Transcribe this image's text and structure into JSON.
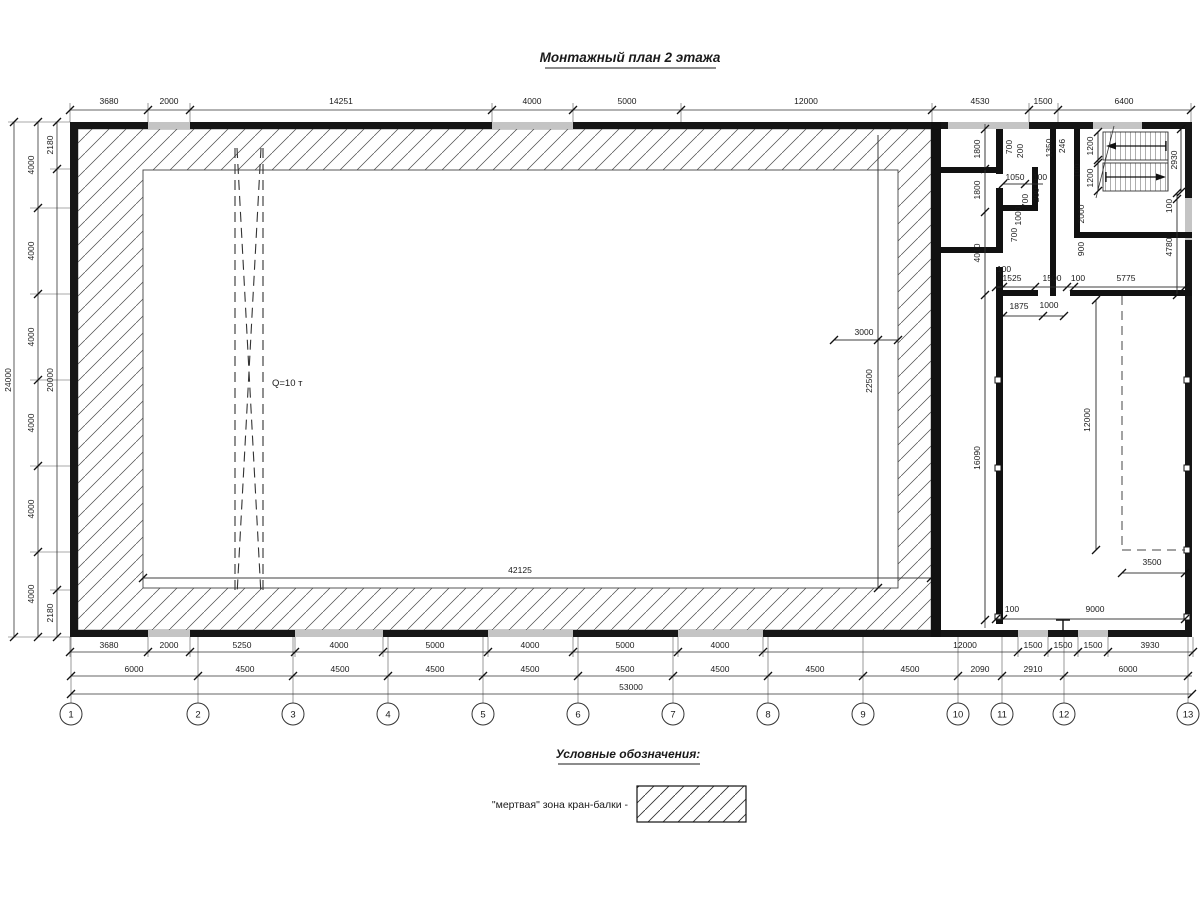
{
  "title": "Монтажный план 2 этажа",
  "legend": {
    "heading": "Условные обозначения:",
    "items": [
      {
        "label": "\"мертвая\" зона кран-балки -",
        "symbol": "hatched-rect"
      }
    ]
  },
  "crane": {
    "capacity_label": "Q=10 т"
  },
  "axis_bubbles": [
    "1",
    "2",
    "3",
    "4",
    "5",
    "6",
    "7",
    "8",
    "9",
    "10",
    "11",
    "12",
    "13"
  ],
  "dimension_labels": [
    {
      "t": "3680",
      "x": 109,
      "y": 104
    },
    {
      "t": "2000",
      "x": 169,
      "y": 104
    },
    {
      "t": "14251",
      "x": 341,
      "y": 104
    },
    {
      "t": "4000",
      "x": 532,
      "y": 104
    },
    {
      "t": "5000",
      "x": 627,
      "y": 104
    },
    {
      "t": "12000",
      "x": 806,
      "y": 104
    },
    {
      "t": "4530",
      "x": 980,
      "y": 104
    },
    {
      "t": "1500",
      "x": 1043,
      "y": 104
    },
    {
      "t": "6400",
      "x": 1124,
      "y": 104
    },
    {
      "t": "3680",
      "x": 109,
      "y": 648
    },
    {
      "t": "2000",
      "x": 169,
      "y": 648
    },
    {
      "t": "5250",
      "x": 242,
      "y": 648
    },
    {
      "t": "4000",
      "x": 339,
      "y": 648
    },
    {
      "t": "5000",
      "x": 435,
      "y": 648
    },
    {
      "t": "4000",
      "x": 530,
      "y": 648
    },
    {
      "t": "5000",
      "x": 625,
      "y": 648
    },
    {
      "t": "4000",
      "x": 720,
      "y": 648
    },
    {
      "t": "12000",
      "x": 965,
      "y": 648
    },
    {
      "t": "1500",
      "x": 1033,
      "y": 648
    },
    {
      "t": "1500",
      "x": 1063,
      "y": 648
    },
    {
      "t": "1500",
      "x": 1093,
      "y": 648
    },
    {
      "t": "3930",
      "x": 1150,
      "y": 648
    },
    {
      "t": "6000",
      "x": 134,
      "y": 672
    },
    {
      "t": "4500",
      "x": 245,
      "y": 672
    },
    {
      "t": "4500",
      "x": 340,
      "y": 672
    },
    {
      "t": "4500",
      "x": 435,
      "y": 672
    },
    {
      "t": "4500",
      "x": 530,
      "y": 672
    },
    {
      "t": "4500",
      "x": 625,
      "y": 672
    },
    {
      "t": "4500",
      "x": 720,
      "y": 672
    },
    {
      "t": "4500",
      "x": 815,
      "y": 672
    },
    {
      "t": "4500",
      "x": 910,
      "y": 672
    },
    {
      "t": "2090",
      "x": 980,
      "y": 672
    },
    {
      "t": "2910",
      "x": 1033,
      "y": 672
    },
    {
      "t": "6000",
      "x": 1128,
      "y": 672
    },
    {
      "t": "53000",
      "x": 631,
      "y": 690
    },
    {
      "t": "4000",
      "x": 34,
      "y": 165,
      "r": 1
    },
    {
      "t": "4000",
      "x": 34,
      "y": 251,
      "r": 1
    },
    {
      "t": "4000",
      "x": 34,
      "y": 337,
      "r": 1
    },
    {
      "t": "4000",
      "x": 34,
      "y": 423,
      "r": 1
    },
    {
      "t": "4000",
      "x": 34,
      "y": 509,
      "r": 1
    },
    {
      "t": "4000",
      "x": 34,
      "y": 594,
      "r": 1
    },
    {
      "t": "24000",
      "x": 11,
      "y": 380,
      "r": 1
    },
    {
      "t": "2180",
      "x": 53,
      "y": 145,
      "r": 1
    },
    {
      "t": "20000",
      "x": 53,
      "y": 380,
      "r": 1
    },
    {
      "t": "2180",
      "x": 53,
      "y": 613,
      "r": 1
    },
    {
      "t": "42125",
      "x": 520,
      "y": 573
    },
    {
      "t": "3000",
      "x": 864,
      "y": 335
    },
    {
      "t": "22500",
      "x": 872,
      "y": 381,
      "r": 1
    },
    {
      "t": "1800",
      "x": 980,
      "y": 149,
      "r": 1
    },
    {
      "t": "1800",
      "x": 980,
      "y": 190,
      "r": 1
    },
    {
      "t": "4010",
      "x": 980,
      "y": 253,
      "r": 1
    },
    {
      "t": "16090",
      "x": 980,
      "y": 458,
      "r": 1
    },
    {
      "t": "700",
      "x": 1012,
      "y": 147,
      "r": 1
    },
    {
      "t": "200",
      "x": 1023,
      "y": 151,
      "r": 1
    },
    {
      "t": "1350",
      "x": 1052,
      "y": 148,
      "r": 1
    },
    {
      "t": "246",
      "x": 1065,
      "y": 146,
      "r": 1
    },
    {
      "t": "1050",
      "x": 1015,
      "y": 180
    },
    {
      "t": "100",
      "x": 1040,
      "y": 180
    },
    {
      "t": "700",
      "x": 1028,
      "y": 201,
      "r": 1
    },
    {
      "t": "200",
      "x": 1039,
      "y": 195,
      "r": 1
    },
    {
      "t": "1000",
      "x": 1021,
      "y": 216,
      "r": 1
    },
    {
      "t": "700",
      "x": 1017,
      "y": 235,
      "r": 1
    },
    {
      "t": "2000",
      "x": 1084,
      "y": 214,
      "r": 1
    },
    {
      "t": "900",
      "x": 1084,
      "y": 249,
      "r": 1
    },
    {
      "t": "100",
      "x": 1080,
      "y": 171,
      "r": 1
    },
    {
      "t": "1200",
      "x": 1093,
      "y": 146,
      "r": 1
    },
    {
      "t": "1200",
      "x": 1093,
      "y": 178,
      "r": 1
    },
    {
      "t": "2930",
      "x": 1177,
      "y": 160,
      "r": 1
    },
    {
      "t": "100",
      "x": 1172,
      "y": 206,
      "r": 1
    },
    {
      "t": "4780",
      "x": 1172,
      "y": 247,
      "r": 1
    },
    {
      "t": "100",
      "x": 1004,
      "y": 272
    },
    {
      "t": "1525",
      "x": 1012,
      "y": 281
    },
    {
      "t": "1500",
      "x": 1052,
      "y": 281
    },
    {
      "t": "100",
      "x": 1078,
      "y": 281
    },
    {
      "t": "5775",
      "x": 1126,
      "y": 281
    },
    {
      "t": "1875",
      "x": 1019,
      "y": 309
    },
    {
      "t": "1000",
      "x": 1049,
      "y": 308
    },
    {
      "t": "12000",
      "x": 1090,
      "y": 420,
      "r": 1
    },
    {
      "t": "3500",
      "x": 1152,
      "y": 565
    },
    {
      "t": "100",
      "x": 1012,
      "y": 612
    },
    {
      "t": "9000",
      "x": 1095,
      "y": 612
    }
  ]
}
